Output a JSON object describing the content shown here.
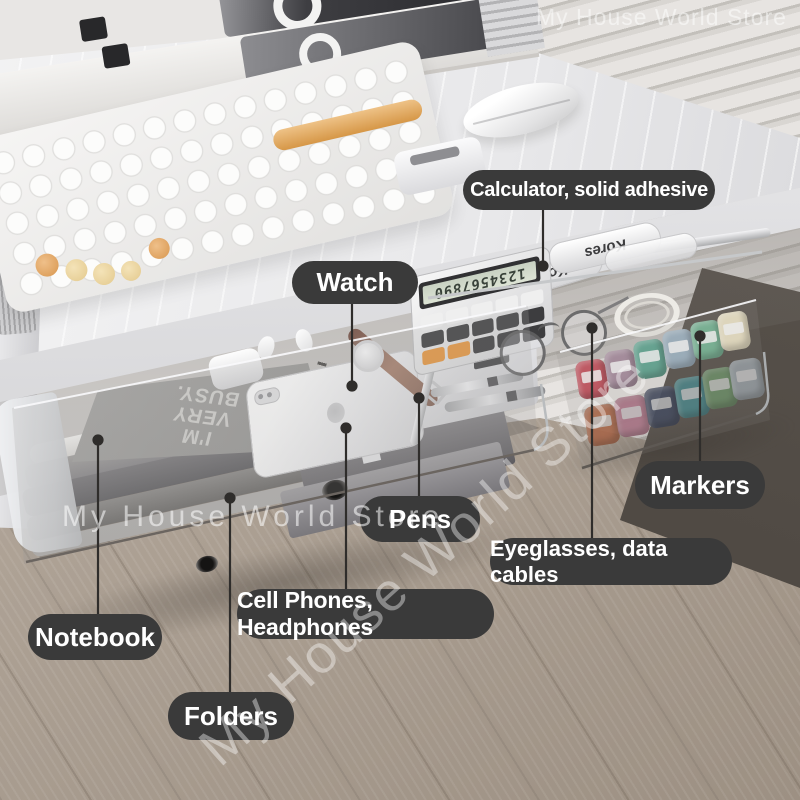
{
  "callouts": {
    "calculator": "Calculator, solid adhesive",
    "watch": "Watch",
    "pens": "Pens",
    "markers": "Markers",
    "eyeglasses": "Eyeglasses, data cables",
    "cellphones": "Cell Phones, Headphones",
    "notebook": "Notebook",
    "folders": "Folders"
  },
  "watermark": {
    "top": "My House World Store",
    "middle": "My House World Store",
    "diagonal": "My House World Store"
  },
  "items": {
    "notebook_cover_text": "I'M VERY BUSY.",
    "glue_brand": "Kores",
    "calculator_display": "1234567890"
  },
  "colors": {
    "label_bg": "#3a3a3a",
    "label_text": "#ffffff",
    "leader_line": "#2f2d2b",
    "accent_orange": "#dfa05c",
    "floor_wood": "#b2a597",
    "corner_shadow": "#55504a",
    "markers": {
      "row1": [
        "#c94f5c",
        "#a98da0",
        "#5ea893",
        "#9eb4c4",
        "#74b795",
        "#efe6c8"
      ],
      "row2": [
        "#d9794f",
        "#d98ba6",
        "#47526e",
        "#52a3a8",
        "#7fae7a",
        "#b9c4cc"
      ]
    }
  }
}
